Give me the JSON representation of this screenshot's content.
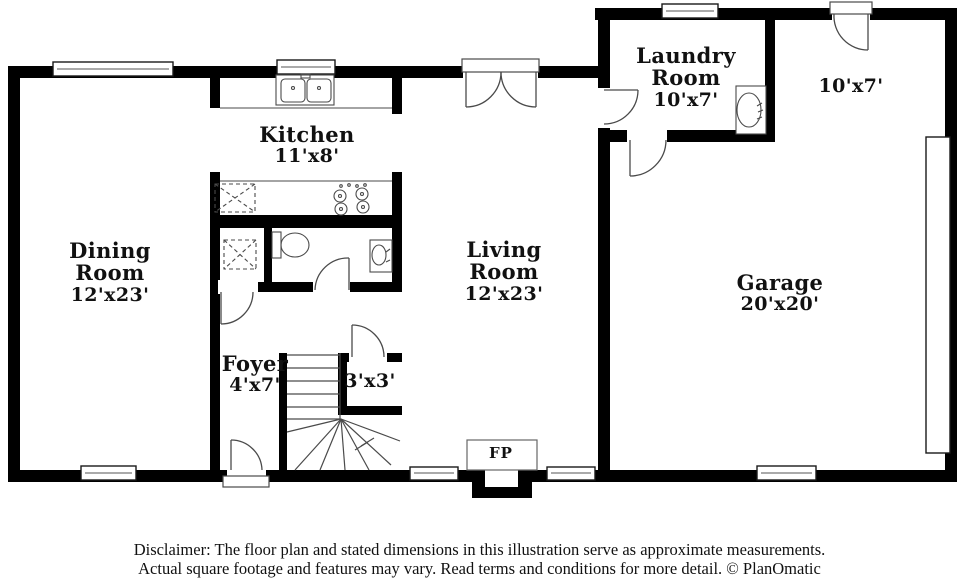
{
  "colors": {
    "wall": "#000000",
    "fixture_outline": "#4a4a4a",
    "background": "#ffffff",
    "text": "#111111"
  },
  "rooms": {
    "dining": {
      "name": "Dining Room",
      "dims": "12'x23'"
    },
    "kitchen": {
      "name": "Kitchen",
      "dims": "11'x8'"
    },
    "living": {
      "name": "Living Room",
      "dims": "12'x23'"
    },
    "laundry": {
      "name": "Laundry Room",
      "dims": "10'x7'"
    },
    "bonus": {
      "dims": "10'x7'"
    },
    "garage": {
      "name": "Garage",
      "dims": "20'x20'"
    },
    "foyer": {
      "name": "Foyer",
      "dims": "4'x7'"
    },
    "closet": {
      "dims": "3'x3'"
    },
    "fireplace": {
      "abbr": "FP"
    }
  },
  "disclaimer": {
    "line1": "Disclaimer: The floor plan and stated dimensions in this illustration serve as approximate measurements.",
    "line2": "Actual square footage and features may vary. Read terms and conditions for more detail. © PlanOmatic"
  }
}
